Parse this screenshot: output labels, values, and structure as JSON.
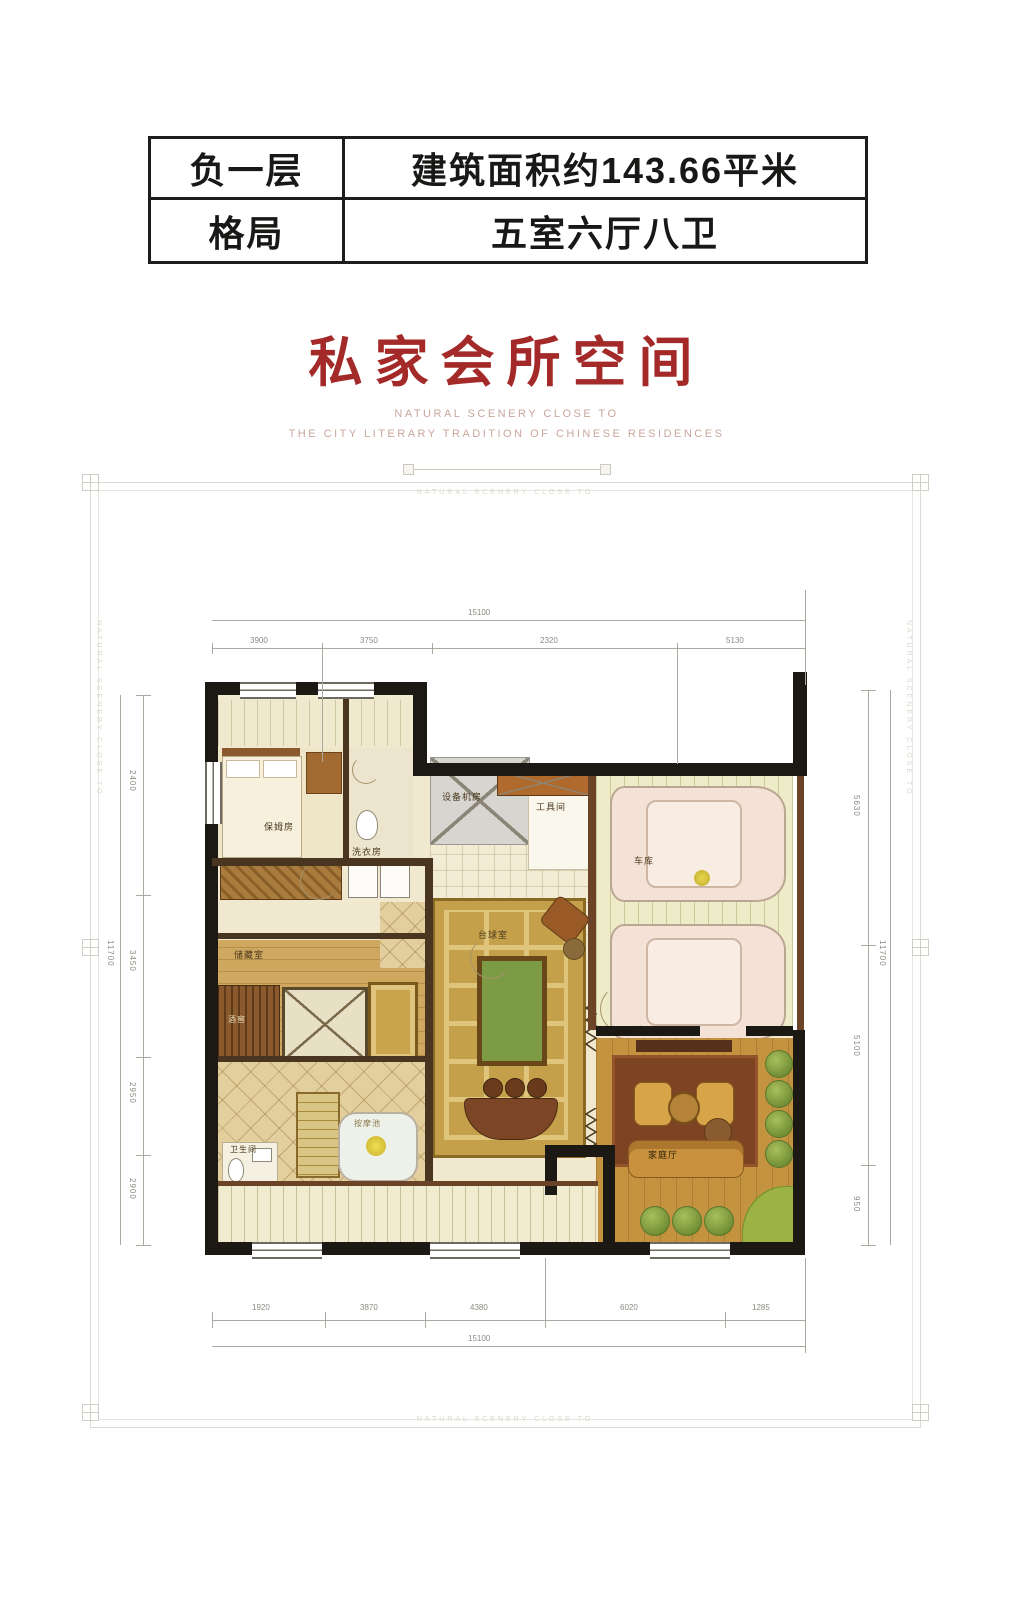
{
  "header_table": {
    "rows": [
      {
        "label": "负一层",
        "value": "建筑面积约143.66平米"
      },
      {
        "label": "格局",
        "value": "五室六厅八卫"
      }
    ]
  },
  "title": "私家会所空间",
  "subtitle_line1": "NATURAL SCENERY CLOSE TO",
  "subtitle_line2": "THE CITY LITERARY TRADITION OF CHINESE RESIDENCES",
  "frame_text_top": "NATURAL SCENERY CLOSE TO",
  "frame_text_bottom": "NATURAL SCENERY CLOSE TO",
  "frame_text_left": "NATURAL SCENERY CLOSE TO",
  "frame_text_right": "NATURAL SCENERY CLOSE TO",
  "colors": {
    "accent_red": "#a32a28",
    "wall_black": "#1c1813",
    "floor_beige": "#f0e9cf",
    "pool_green": "#7d9a44"
  },
  "plan": {
    "rooms": {
      "bedroom": "保姆房",
      "laundry": "洗衣房",
      "equipment": "设备机房",
      "tools": "工具间",
      "garage": "车库",
      "billiards": "台球室",
      "family": "家庭厅",
      "storage": "储藏室",
      "cellar": "酒窖",
      "bath": "卫生间",
      "spa": "按摩池"
    },
    "dims": {
      "top": {
        "total": "15100",
        "segments": [
          "3900",
          "3750",
          "2320",
          "5130"
        ]
      },
      "bottom": {
        "total": "15100",
        "segments": [
          "1920",
          "3870",
          "4380",
          "6020",
          "1285"
        ]
      },
      "left": {
        "total": "11700",
        "segments": [
          "2400",
          "3450",
          "2950",
          "2900"
        ]
      },
      "right": {
        "total": "11700",
        "segments": [
          "5630",
          "5100",
          "950"
        ]
      }
    }
  }
}
